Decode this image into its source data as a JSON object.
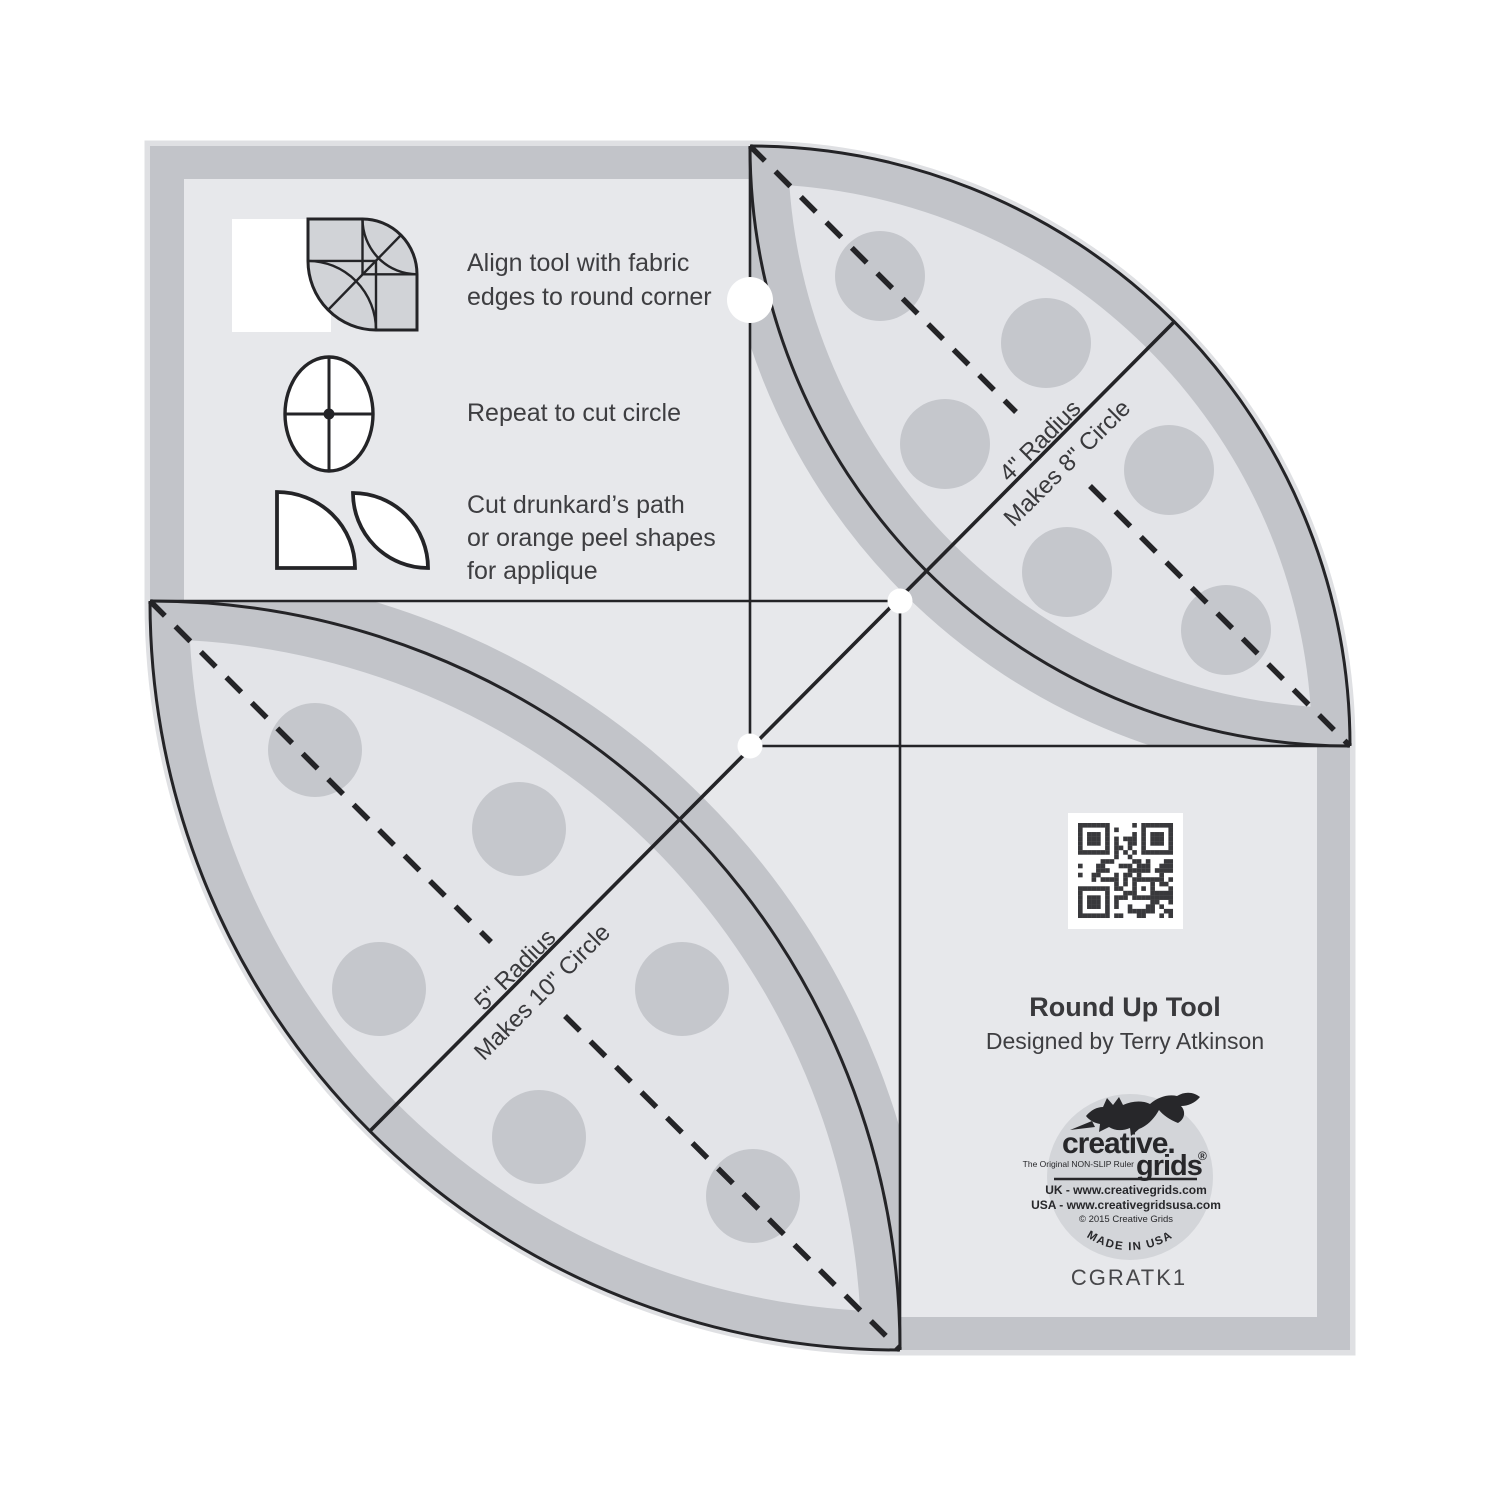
{
  "product": {
    "title": "Round Up Tool",
    "designer": "Designed by Terry Atkinson",
    "code": "CGRATK1"
  },
  "instructions": [
    {
      "lines": [
        "Align tool with fabric",
        "edges to round corner"
      ]
    },
    {
      "lines": [
        "Repeat to cut circle"
      ]
    },
    {
      "lines": [
        "Cut drunkard’s path",
        "or orange peel shapes",
        "for applique"
      ]
    }
  ],
  "petals": [
    {
      "radius_label": "4\" Radius",
      "makes_label": "Makes 8\" Circle"
    },
    {
      "radius_label": "5\" Radius",
      "makes_label": "Makes 10\" Circle"
    }
  ],
  "logo": {
    "brand_top": "creative.",
    "brand_bottom": "grids",
    "registered": "®",
    "tagline": "The Original NON-SLIP Ruler",
    "uk_line": "UK - www.creativegrids.com",
    "usa_line": "USA - www.creativegridsusa.com",
    "copyright_line": "© 2015  Creative Grids",
    "made_in": "MADE IN USA"
  },
  "icons": {
    "fox_logo": "leaping-fox-silhouette",
    "qr_code": "qr-code"
  },
  "colors": {
    "background": "#ffffff",
    "edge_halo": "#dfe0e3",
    "body_band": "#c2c4c9",
    "body_interior": "#e7e8eb",
    "lens_core": "#e3e4e8",
    "grip_dot": "#c5c7cc",
    "line_black": "#242427",
    "text_dark": "#3e3e41",
    "logo_circle": "#d3d5d9",
    "qr_dark": "#39393c"
  }
}
